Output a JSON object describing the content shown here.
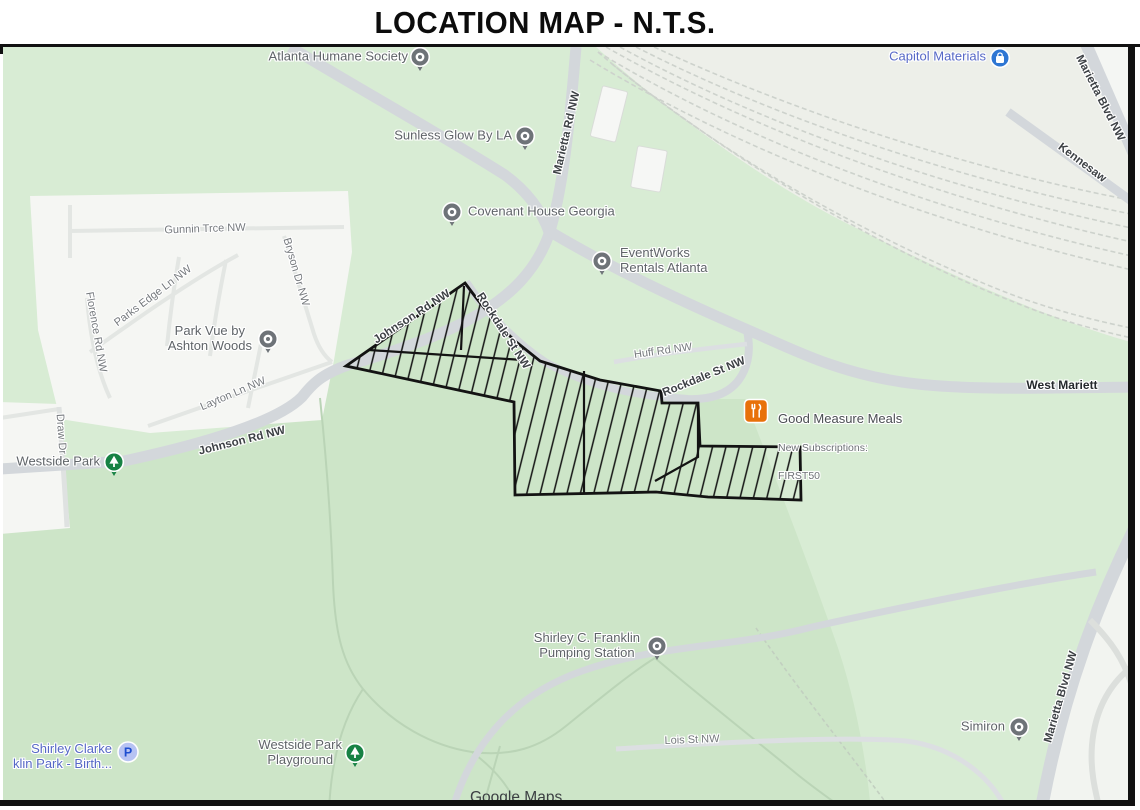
{
  "title": "LOCATION MAP - N.T.S.",
  "attribution": "Google Maps",
  "colors": {
    "map_green": "#d8ecd4",
    "park_green": "#cde5c8",
    "road_gray": "#d3d7db",
    "site_outline": "#131313",
    "poi_label_gray": "#5f6468",
    "poi_label_blue": "#5668c6",
    "restaurant_marker_orange": "#e8710a",
    "park_marker_green": "#178244",
    "shopping_marker_blue": "#2e76d3"
  },
  "pois": [
    {
      "label": "Atlanta Humane Society",
      "marker": "place-icon"
    },
    {
      "label": "Sunless Glow By LA",
      "marker": "place-icon"
    },
    {
      "label": "Covenant House Georgia",
      "marker": "place-icon"
    },
    {
      "label": "EventWorks\nRentals Atlanta",
      "marker": "place-icon"
    },
    {
      "label": "Capitol Materials",
      "marker": "shopping-bag-icon"
    },
    {
      "label": "Park Vue by\nAshton Woods",
      "marker": "place-icon"
    },
    {
      "label": "Westside Park",
      "marker": "park-tree-icon"
    },
    {
      "label": "Good Measure Meals",
      "sub": "New Subscriptions:",
      "code": "FIRST50",
      "marker": "restaurant-icon"
    },
    {
      "label": "Shirley C. Franklin\nPumping Station",
      "marker": "place-icon"
    },
    {
      "label": "Westside Park\nPlayground",
      "marker": "park-tree-icon"
    },
    {
      "label": "Shirley Clarke\nklin Park - Birth...",
      "marker": "parking-icon",
      "marker_letter": "P"
    },
    {
      "label": "Simiron",
      "marker": "place-icon"
    }
  ],
  "streets": [
    {
      "label": "Marietta Rd NW"
    },
    {
      "label": "Gunnin Trce NW"
    },
    {
      "label": "Bryson Dr NW"
    },
    {
      "label": "Parks Edge Ln NW"
    },
    {
      "label": "Florence Rd NW"
    },
    {
      "label": "Layton Ln NW"
    },
    {
      "label": "Johnson Rd NW"
    },
    {
      "label": "Johnson Rd NW"
    },
    {
      "label": "Draw Dr"
    },
    {
      "label": "Rockdale St NW"
    },
    {
      "label": "Huff Rd NW"
    },
    {
      "label": "Rockdale St NW"
    },
    {
      "label": "West Mariett"
    },
    {
      "label": "Marietta Blvd NW"
    },
    {
      "label": "Kennesaw"
    },
    {
      "label": "Marietta Blvd NW"
    },
    {
      "label": "Lois St NW"
    }
  ]
}
